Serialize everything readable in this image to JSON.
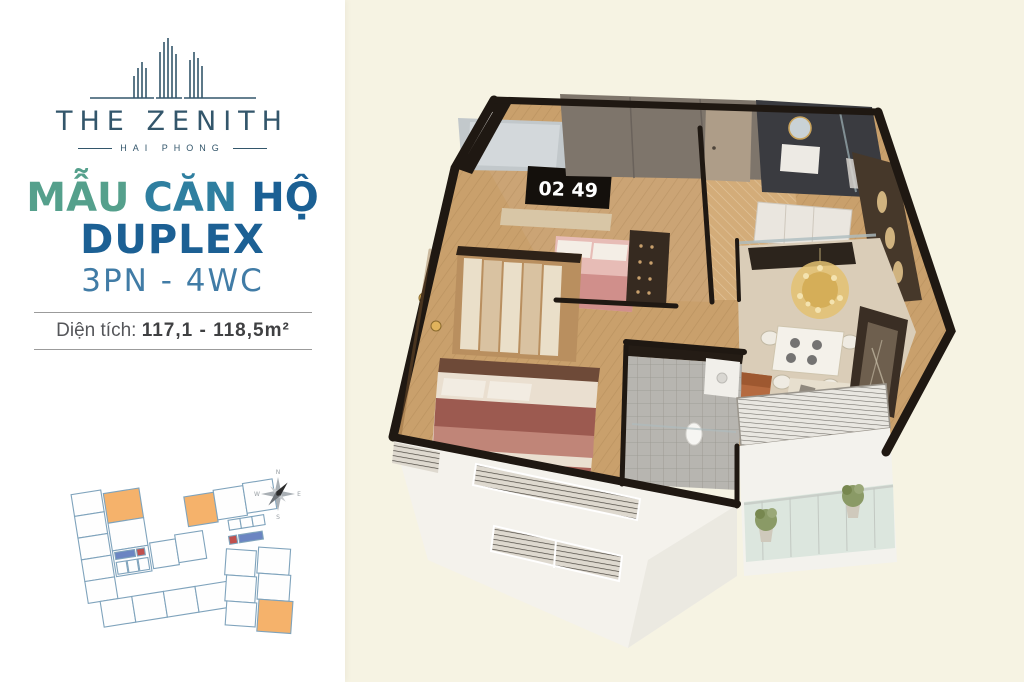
{
  "page": {
    "background": "#F6F3E3",
    "panel_background": "#FFFFFF"
  },
  "logo": {
    "title": "THE ZENITH",
    "subtitle": "HAI PHONG",
    "color": "#33566B"
  },
  "headline": {
    "line1_words": [
      {
        "text": "MẪU",
        "color": "#55A08C"
      },
      {
        "text": "CĂN",
        "color": "#2F7FA0"
      },
      {
        "text": "HỘ",
        "color": "#1B6094"
      }
    ],
    "line2": "DUPLEX",
    "line2_color": "#1C6094",
    "line3": "3PN - 4WC",
    "line3_color": "#417CA6"
  },
  "area": {
    "label": "Diện tích:",
    "value": "117,1 - 118,5m²",
    "text_color": "#55565A"
  },
  "floorplan": {
    "tv_clock": "02 49",
    "colors": {
      "wall_dark": "#1F1812",
      "wood_floor": "#C9A06C",
      "marble_wall": "#7E756B",
      "bed_maroon": "#9C5A50",
      "bed_pink": "#E7BCB6",
      "dining_floor": "#DACDB8",
      "tile_gray": "#B7B5B0",
      "facade_white": "#F4F2EC",
      "balcony_glass": "#DCE6DE",
      "gold": "#D4AC54"
    }
  },
  "keyplan": {
    "outline_color": "#7FA3BC",
    "highlight_color": "#F5B26B",
    "core_blue": "#6B85C2",
    "core_red": "#C0504D",
    "compass_labels": {
      "n": "N",
      "e": "E",
      "s": "S",
      "w": "W"
    }
  }
}
